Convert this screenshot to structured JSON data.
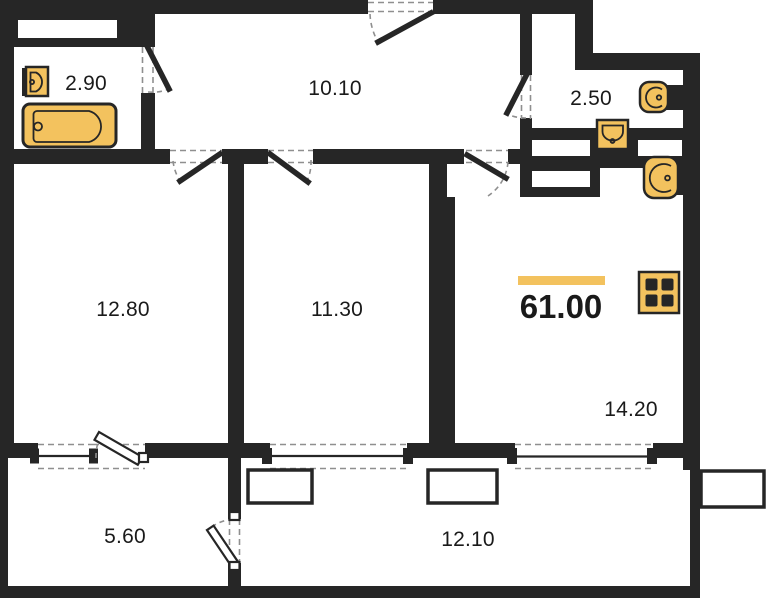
{
  "plan": {
    "total_area_label": "61.00",
    "rooms": [
      {
        "id": "bathroom",
        "label": "2.90"
      },
      {
        "id": "hallway",
        "label": "10.10"
      },
      {
        "id": "wc",
        "label": "2.50"
      },
      {
        "id": "bedroom",
        "label": "12.80"
      },
      {
        "id": "bedroom-2",
        "label": "11.30"
      },
      {
        "id": "kitchen-living",
        "label": "14.20"
      },
      {
        "id": "balcony",
        "label": "5.60"
      },
      {
        "id": "loggia",
        "label": "12.10"
      }
    ],
    "fixtures": [
      "bathtub-icon",
      "sink-icon",
      "sink-icon",
      "toilet-icon",
      "toilet-icon",
      "stove-icon"
    ],
    "colors": {
      "wall": "#262626",
      "accent": "#F3C25E",
      "dash": "#8F8F8F",
      "text": "#1A1A1A",
      "bg": "#FFFFFF"
    }
  }
}
